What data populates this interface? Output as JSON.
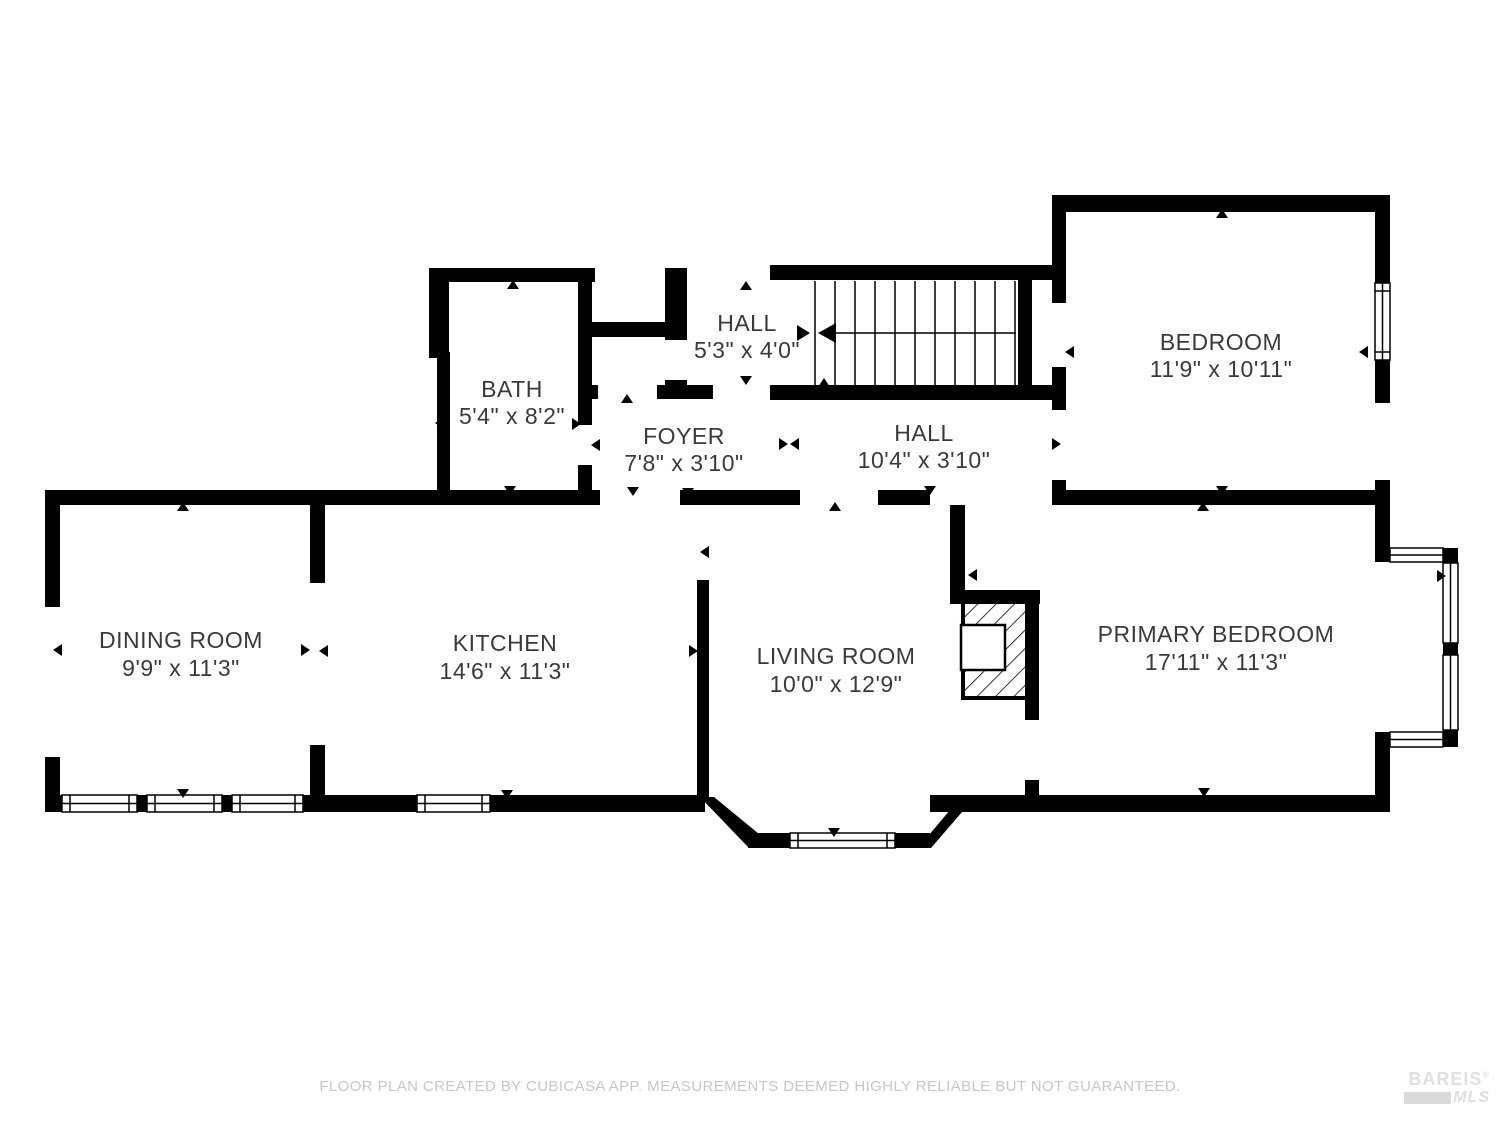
{
  "plan": {
    "rooms": [
      {
        "name": "HALL",
        "dims": "5'3\" x 4'0\""
      },
      {
        "name": "BATH",
        "dims": "5'4\" x 8'2\""
      },
      {
        "name": "FOYER",
        "dims": "7'8\" x 3'10\""
      },
      {
        "name": "HALL",
        "dims": "10'4\" x 3'10\""
      },
      {
        "name": "BEDROOM",
        "dims": "11'9\" x 10'11\""
      },
      {
        "name": "DINING ROOM",
        "dims": "9'9\" x 11'3\""
      },
      {
        "name": "KITCHEN",
        "dims": "14'6\" x 11'3\""
      },
      {
        "name": "LIVING ROOM",
        "dims": "10'0\" x 12'9\""
      },
      {
        "name": "PRIMARY BEDROOM",
        "dims": "17'11\" x 11'3\""
      }
    ]
  },
  "footer": {
    "disclaimer": "FLOOR PLAN CREATED BY CUBICASA APP. MEASUREMENTS DEEMED HIGHLY RELIABLE BUT NOT GUARANTEED."
  },
  "watermark": {
    "brand": "BAREIS",
    "registered": "®",
    "sub": "MLS"
  },
  "colors": {
    "wall": "#000000",
    "room_label": "#3a3a3a",
    "disclaimer_text": "#c7c7c7",
    "watermark_text": "#e0e0e0"
  }
}
